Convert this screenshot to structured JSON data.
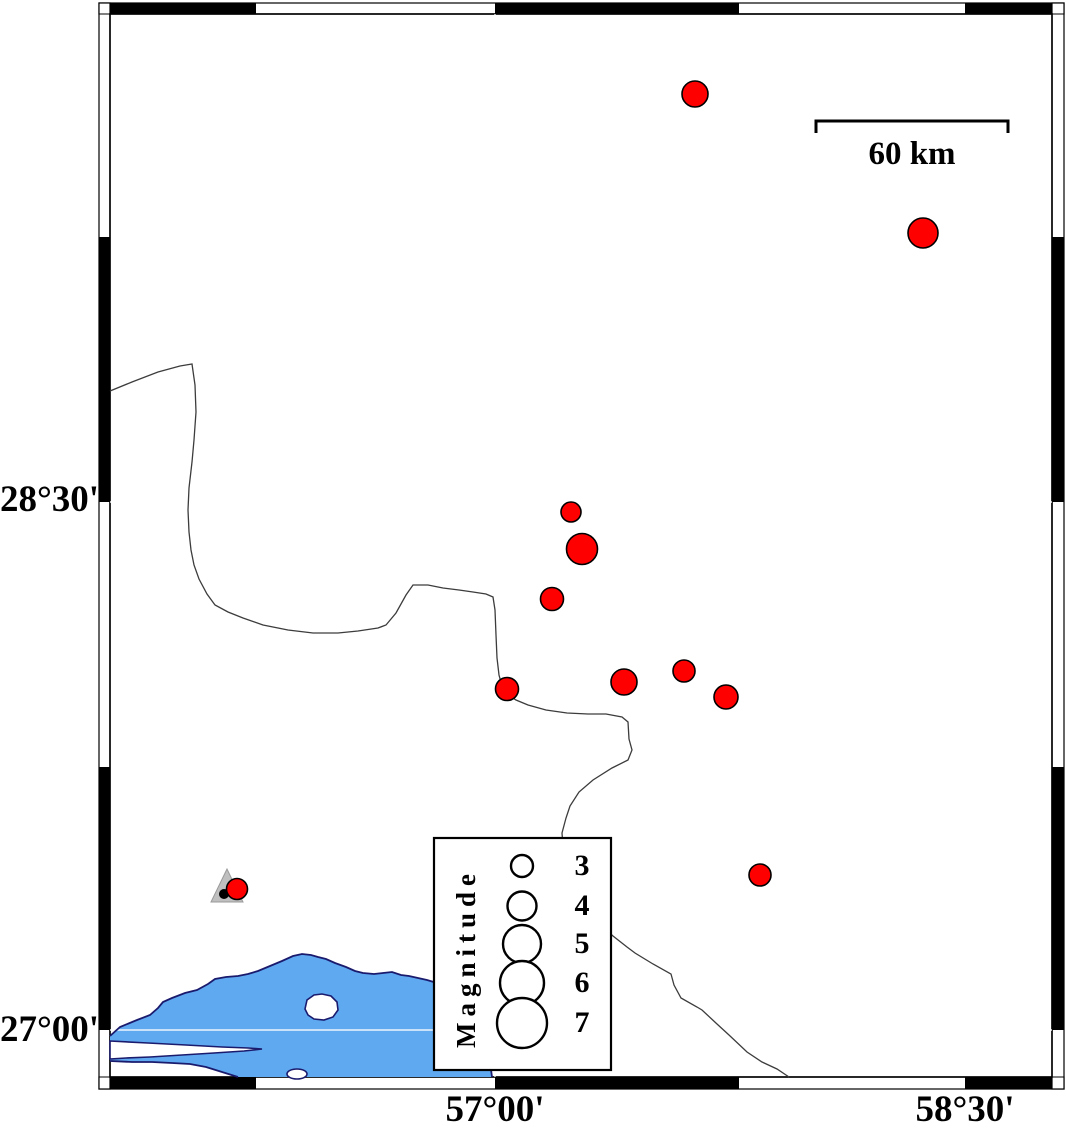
{
  "axis": {
    "left": [
      {
        "text": "28°30'"
      },
      {
        "text": "27°00'"
      }
    ],
    "bottom": [
      {
        "text": "57°00'"
      },
      {
        "text": "58°30'"
      }
    ]
  },
  "scale_bar": {
    "label": "60 km",
    "length_px": 192
  },
  "legend": {
    "title": "Magnitude",
    "circle_cx": 522,
    "entries": [
      {
        "label": "3",
        "cy": 866,
        "r": 11
      },
      {
        "label": "4",
        "cy": 906,
        "r": 14.5
      },
      {
        "label": "5",
        "cy": 944,
        "r": 19
      },
      {
        "label": "6",
        "cy": 983,
        "r": 22
      },
      {
        "label": "7",
        "cy": 1023,
        "r": 25
      }
    ]
  },
  "earthquakes": [
    {
      "x": 695,
      "y": 94,
      "r": 13
    },
    {
      "x": 923,
      "y": 233,
      "r": 15
    },
    {
      "x": 571,
      "y": 512,
      "r": 10
    },
    {
      "x": 582,
      "y": 549,
      "r": 15.5
    },
    {
      "x": 552,
      "y": 599,
      "r": 11.5
    },
    {
      "x": 507,
      "y": 689,
      "r": 11.5
    },
    {
      "x": 624,
      "y": 682,
      "r": 13
    },
    {
      "x": 684,
      "y": 671,
      "r": 11
    },
    {
      "x": 726,
      "y": 697,
      "r": 12
    },
    {
      "x": 760,
      "y": 875,
      "r": 11
    },
    {
      "x": 237,
      "y": 889,
      "r": 10.5
    }
  ],
  "station": {
    "symbol": "triangle",
    "x": 227,
    "y": 886
  },
  "colors": {
    "quake_fill": "#FF0000",
    "quake_stroke": "#000000",
    "water": "#5FA9F1",
    "coast": "#1B1B6E",
    "land": "#FFFFFF",
    "boundary": "#3C3C3C",
    "triangle": "#BFBFBF",
    "frame": "#000000"
  }
}
